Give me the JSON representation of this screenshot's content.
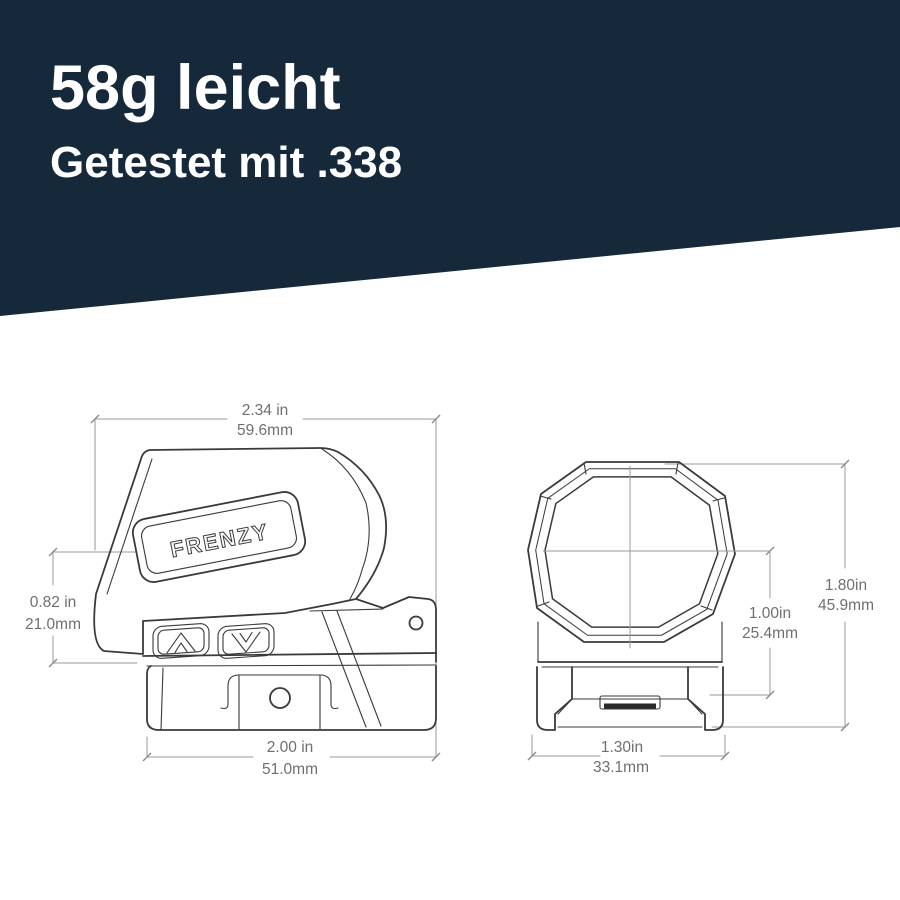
{
  "banner": {
    "title": "58g leicht",
    "subtitle": "Getestet mit .338",
    "bg_color": "#16293a",
    "text_color": "#ffffff"
  },
  "logo": {
    "brand": "FRENZY"
  },
  "views": {
    "side": {
      "dims": {
        "top": {
          "inch": "2.34 in",
          "mm": "59.6mm"
        },
        "left": {
          "inch": "0.82 in",
          "mm": "21.0mm"
        },
        "bottom": {
          "inch": "2.00 in",
          "mm": "51.0mm"
        }
      }
    },
    "front": {
      "dims": {
        "height": {
          "inch": "1.80in",
          "mm": "45.9mm"
        },
        "center": {
          "inch": "1.00in",
          "mm": "25.4mm"
        },
        "rail": {
          "inch": "1.30in",
          "mm": "33.1mm"
        }
      }
    }
  },
  "colors": {
    "outline": "#3a3a3a",
    "dimension_line": "#9a9a9a",
    "dimension_text": "#6f6f6f"
  }
}
